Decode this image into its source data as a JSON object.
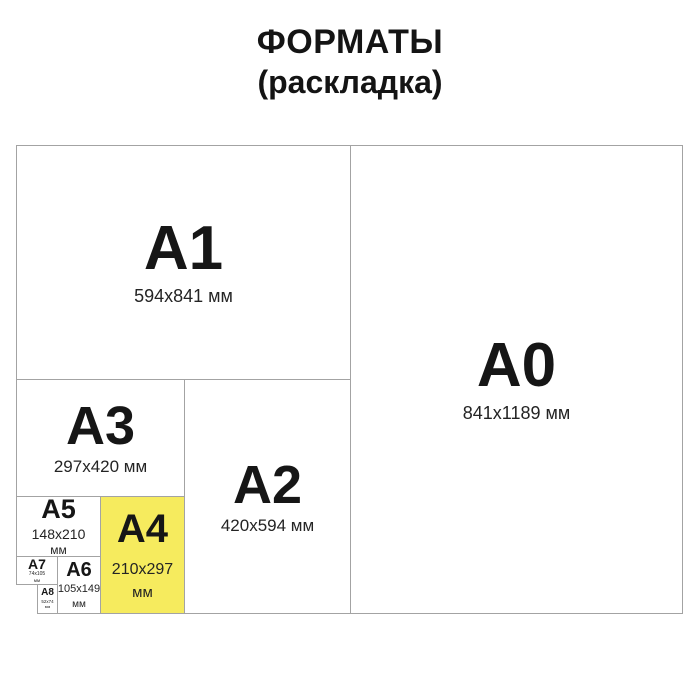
{
  "title": {
    "line1": "ФОРМАТЫ",
    "line2": "(раскладка)"
  },
  "colors": {
    "background": "#FFFFFF",
    "box_border": "#A3A3A3",
    "text": "#161616",
    "highlight_fill": "#F6EB5E"
  },
  "highlighted_format": "A4",
  "formats": [
    {
      "label": "A0",
      "size": "841x1189 мм"
    },
    {
      "label": "A1",
      "size": "594x841 мм"
    },
    {
      "label": "A2",
      "size": "420x594 мм"
    },
    {
      "label": "A3",
      "size": "297x420 мм"
    },
    {
      "label": "A4",
      "size": "210x297",
      "unit": "мм",
      "highlighted": true
    },
    {
      "label": "A5",
      "size": "148x210",
      "unit": "мм"
    },
    {
      "label": "A6",
      "size": "105x149",
      "unit": "мм"
    },
    {
      "label": "A7",
      "size": "74x105",
      "unit": "мм"
    },
    {
      "label": "A8",
      "size": "52x74",
      "unit": "мм"
    }
  ]
}
